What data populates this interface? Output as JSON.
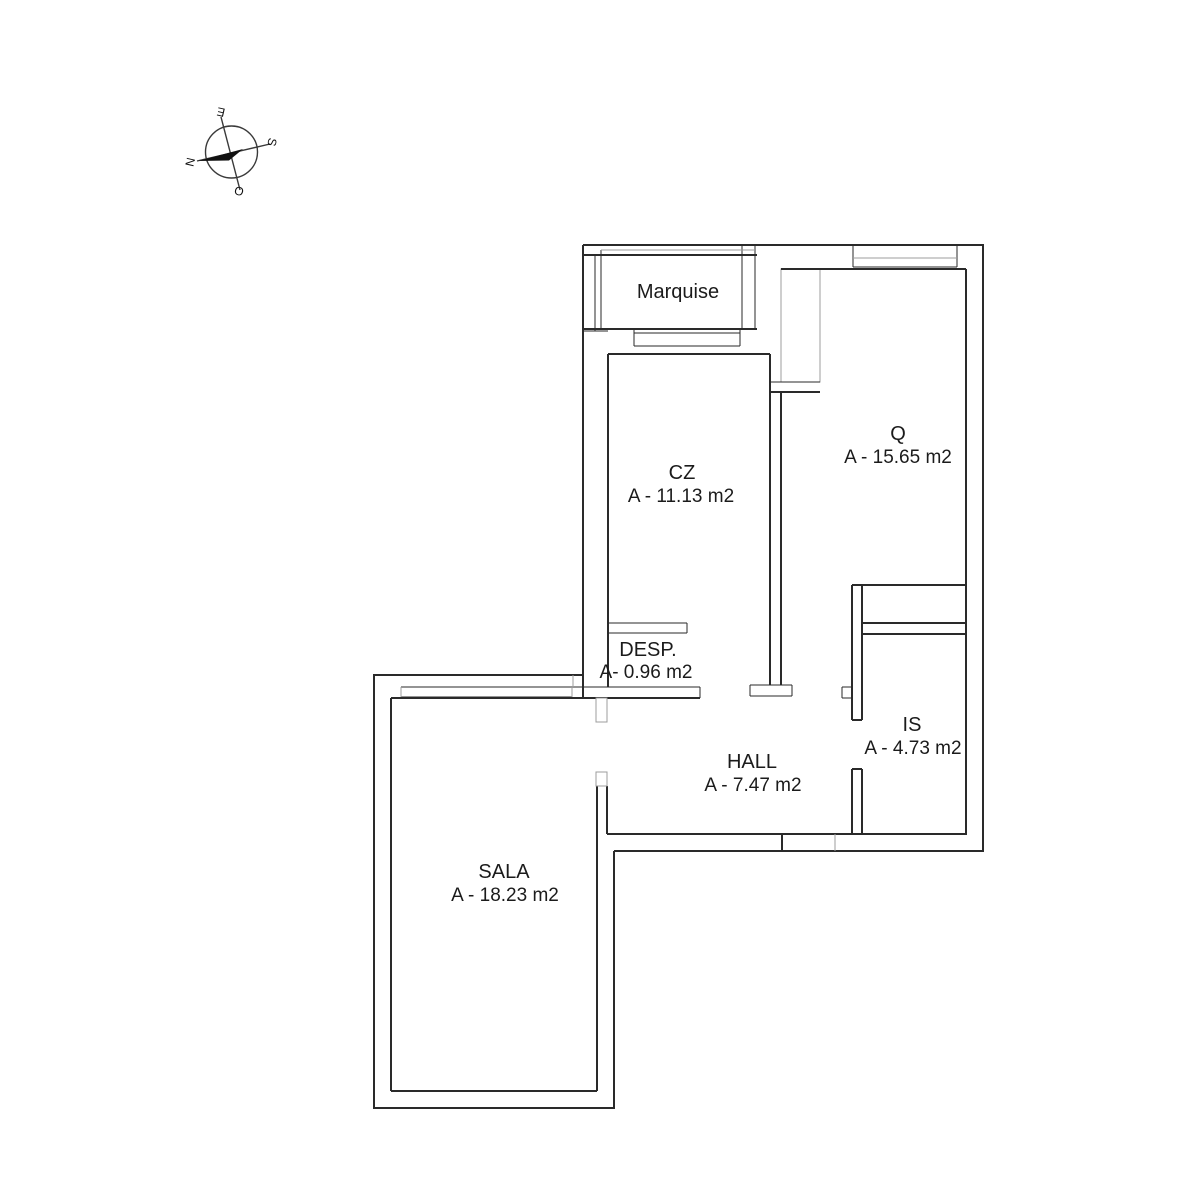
{
  "compass": {
    "north": "N",
    "south": "S",
    "east": "E",
    "west": "O"
  },
  "rooms": {
    "marquise": {
      "name": "Marquise"
    },
    "cz": {
      "name": "CZ",
      "area": "A - 11.13 m2"
    },
    "q": {
      "name": "Q",
      "area": "A - 15.65 m2"
    },
    "desp": {
      "name": "DESP.",
      "area": "A- 0.96 m2"
    },
    "is": {
      "name": "IS",
      "area": "A - 4.73 m2"
    },
    "hall": {
      "name": "HALL",
      "area": "A - 7.47 m2"
    },
    "sala": {
      "name": "SALA",
      "area": "A - 18.23 m2"
    }
  },
  "colors": {
    "wall": "#2a2a2a",
    "light": "#9c9c9c",
    "background": "#ffffff",
    "needle": "#111111"
  }
}
